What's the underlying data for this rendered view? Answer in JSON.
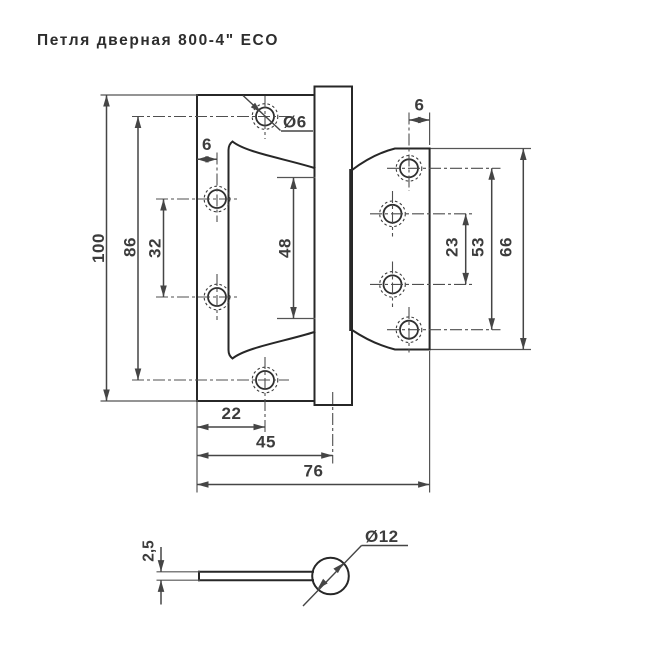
{
  "title": "Петля дверная 800-4\" ECO",
  "colors": {
    "object_line": "#272727",
    "dimension_line": "#454545",
    "background": "#ffffff"
  },
  "views": {
    "front": {
      "dims": {
        "overall_height": "100",
        "left_outer_holes_span": "86",
        "left_inner_holes_span": "32",
        "left_hole_edge_offset": "6",
        "hole_diameter": "Ø6",
        "knuckle_length": "48",
        "right_hole_edge_offset": "6",
        "right_inner_holes_span": "23",
        "right_outer_holes_span": "53",
        "right_leaf_height": "66",
        "hole_from_left_edge": "22",
        "pin_axis_from_left_edge": "45",
        "overall_width": "76"
      }
    },
    "side": {
      "dims": {
        "leaf_thickness": "2,5",
        "barrel_diameter": "Ø12"
      }
    }
  }
}
